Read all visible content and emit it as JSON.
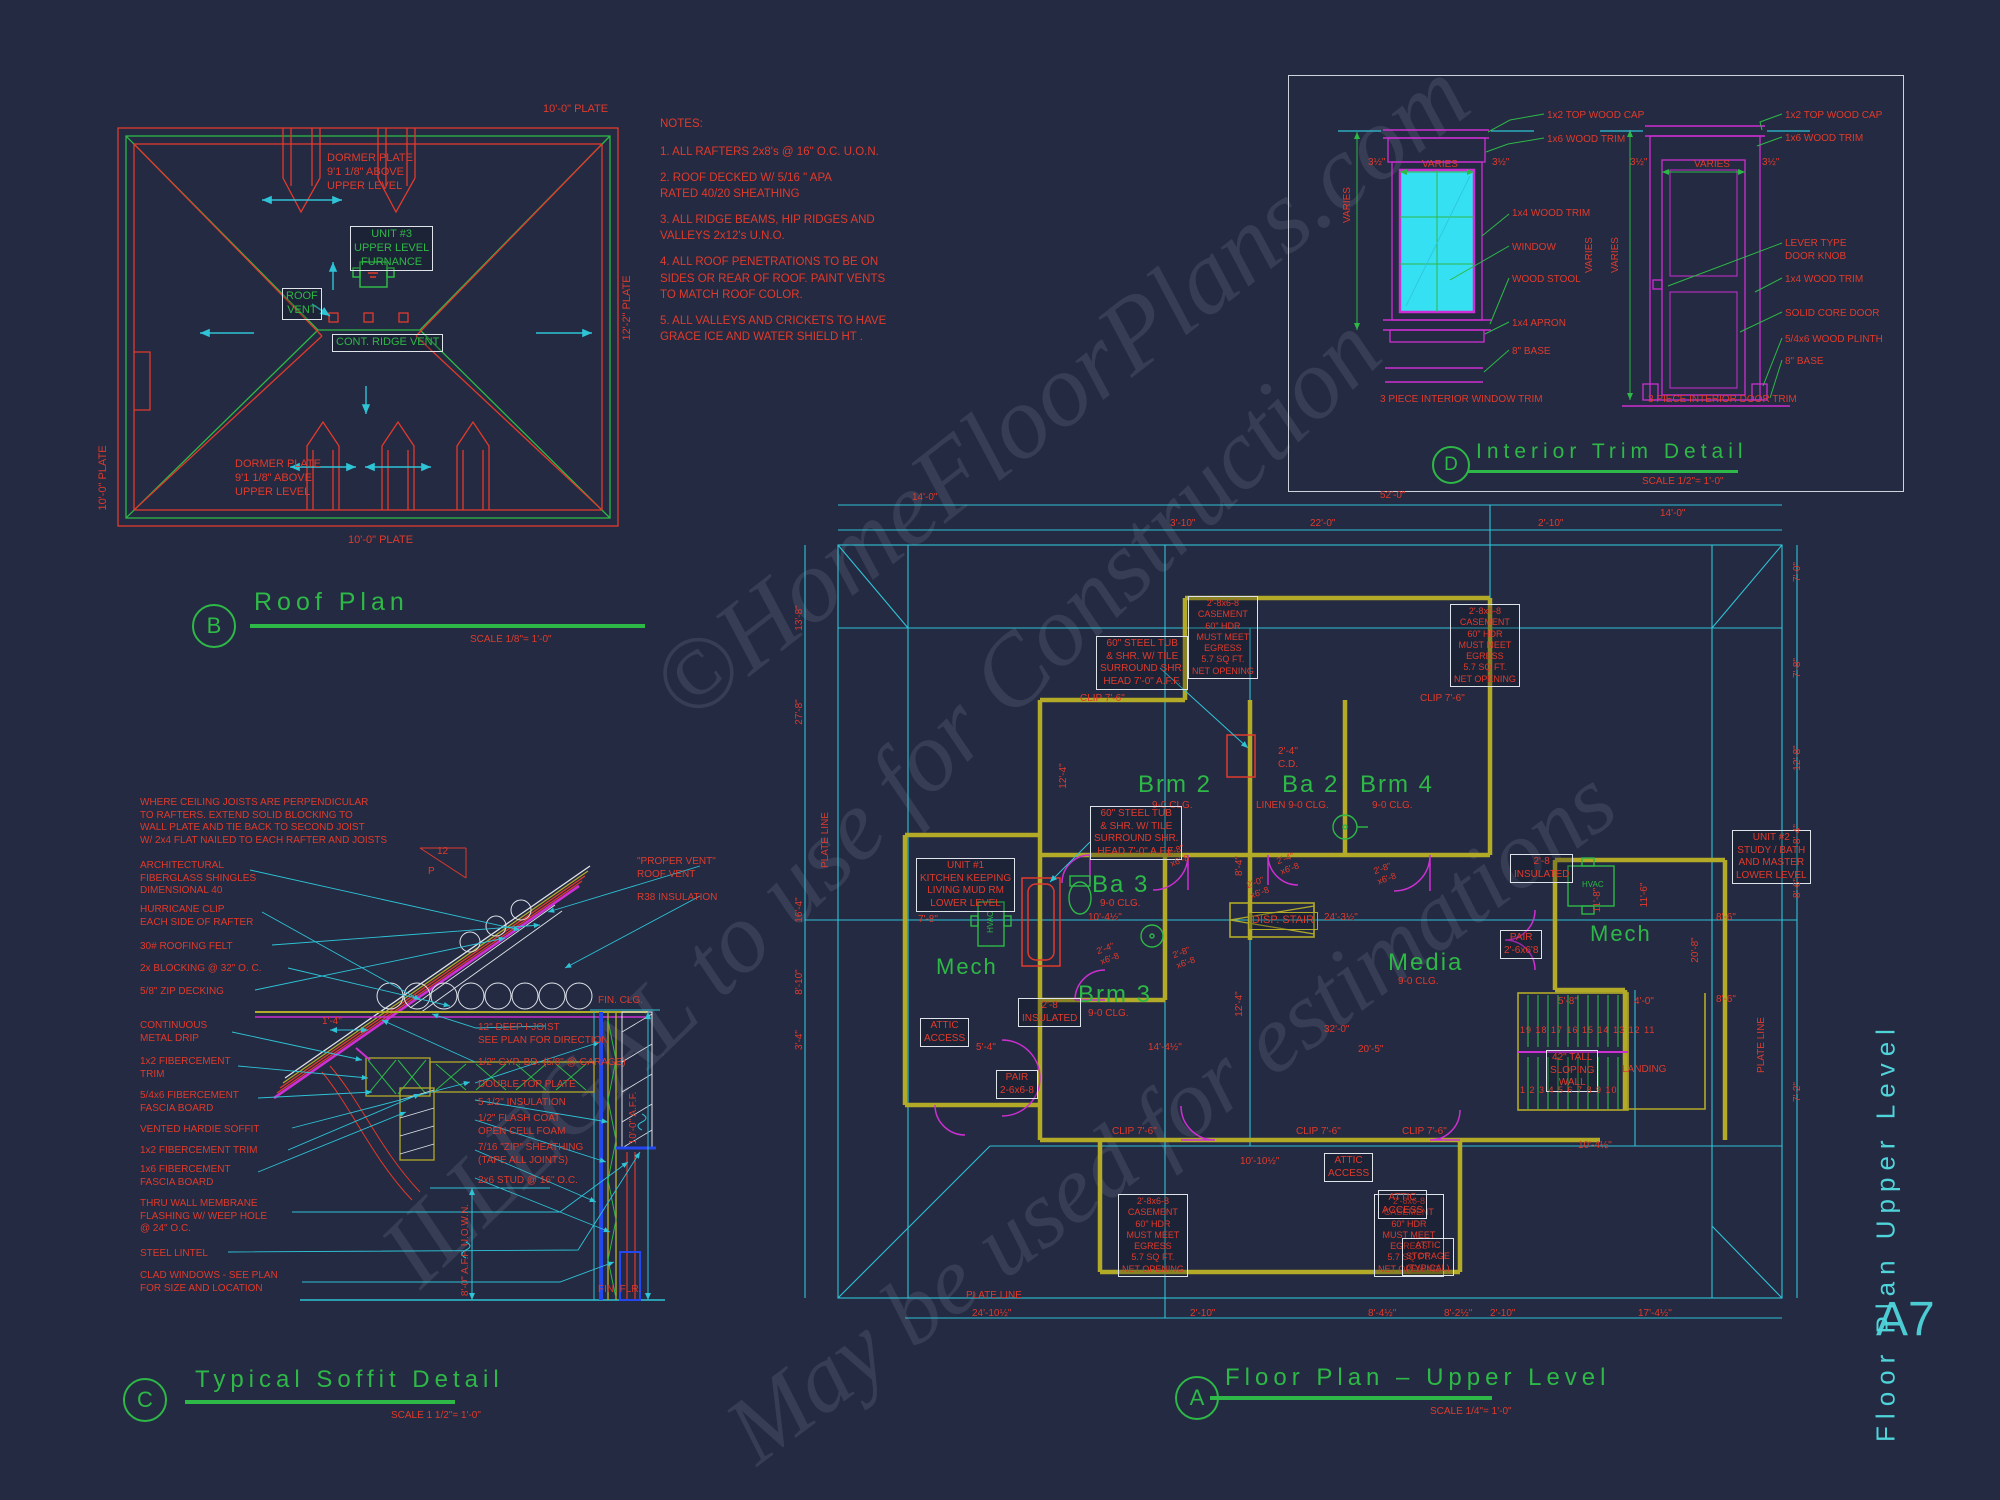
{
  "palette": {
    "red": "#e13a2c",
    "green": "#2eb847",
    "cyan": "#2fc3d6",
    "magenta": "#cd2fd2",
    "yellow": "#b3aa28",
    "white": "#dfe3ea",
    "blue": "#2547f0"
  },
  "sheet": {
    "number": "A7",
    "side_title": "Floor  Plan  Upper  Level"
  },
  "watermark": {
    "line1": "©HomeFloorPlans.com",
    "line2": "ILLEGAL to use for Construction",
    "line3": "May be used for estimations"
  },
  "titles": [
    {
      "letter": "B",
      "title": "Roof Plan",
      "scale": "SCALE 1/8\"= 1'-0\""
    },
    {
      "letter": "C",
      "title": "Typical Soffit Detail",
      "scale": "SCALE 1 1/2\"= 1'-0\""
    },
    {
      "letter": "A",
      "title": "Floor Plan – Upper Level",
      "scale": "SCALE 1/4\"= 1'-0\""
    },
    {
      "letter": "D",
      "title": "Interior Trim Detail",
      "scale": "SCALE 1/2\"= 1'-0\""
    }
  ],
  "notes": {
    "heading": "NOTES:",
    "items": [
      "1. ALL RAFTERS 2x8's @ 16\" O.C. U.O.N.",
      "2. ROOF DECKED W/ 5/16 \" APA\n    RATED 40/20 SHEATHING",
      "3. ALL RIDGE BEAMS, HIP RIDGES AND\n    VALLEYS 2x12's U.N.O.",
      "4. ALL ROOF PENETRATIONS TO BE ON\n    SIDES OR REAR OF ROOF.  PAINT VENTS\n    TO MATCH ROOF COLOR.",
      "5. ALL VALLEYS AND CRICKETS TO HAVE\nGRACE ICE AND WATER SHIELD HT ."
    ]
  },
  "labels": [
    {
      "t": "10'-0\" PLATE",
      "x": 543,
      "y": 103
    },
    {
      "t": "DORMER PLATE\n9'1 1/8\" ABOVE\nUPPER LEVEL",
      "x": 327,
      "y": 152
    },
    {
      "t": "UNIT #3\nUPPER LEVEL\nFURNANCE",
      "x": 350,
      "y": 226,
      "c": "green",
      "b": 1
    },
    {
      "t": "ROOF\nVENT",
      "x": 282,
      "y": 288,
      "c": "green",
      "b": 1
    },
    {
      "t": "CONT. RIDGE VENT",
      "x": 332,
      "y": 334,
      "c": "green",
      "b": 1
    },
    {
      "t": "DORMER PLATE\n9'1 1/8\" ABOVE\nUPPER LEVEL",
      "x": 235,
      "y": 458
    },
    {
      "t": "10'-0\" PLATE",
      "x": 348,
      "y": 534
    },
    {
      "t": "10'-0\" PLATE",
      "x": 104,
      "y": 478,
      "r": -90
    },
    {
      "t": "12'-2\" PLATE",
      "x": 628,
      "y": 308,
      "r": -90
    },
    {
      "t": "1x2 TOP WOOD CAP",
      "x": 1547,
      "y": 110,
      "s": 10
    },
    {
      "t": "1x6 WOOD TRIM",
      "x": 1547,
      "y": 134,
      "s": 10
    },
    {
      "t": "3½\"",
      "x": 1368,
      "y": 157,
      "s": 10
    },
    {
      "t": "VARIES",
      "x": 1422,
      "y": 159,
      "s": 10
    },
    {
      "t": "3½\"",
      "x": 1492,
      "y": 157,
      "s": 10
    },
    {
      "t": "VARIES",
      "x": 1348,
      "y": 205,
      "s": 10,
      "r": -90
    },
    {
      "t": "VARIES",
      "x": 1590,
      "y": 255,
      "s": 10,
      "r": -90
    },
    {
      "t": "1x4 WOOD TRIM",
      "x": 1512,
      "y": 208,
      "s": 10
    },
    {
      "t": "WINDOW",
      "x": 1512,
      "y": 242,
      "s": 10
    },
    {
      "t": "WOOD STOOL",
      "x": 1512,
      "y": 274,
      "s": 10
    },
    {
      "t": "1x4 APRON",
      "x": 1512,
      "y": 318,
      "s": 10
    },
    {
      "t": "8\" BASE",
      "x": 1512,
      "y": 346,
      "s": 10
    },
    {
      "t": "3 PIECE INTERIOR WINDOW TRIM",
      "x": 1380,
      "y": 394,
      "s": 10
    },
    {
      "t": "1x2 TOP WOOD CAP",
      "x": 1785,
      "y": 110,
      "s": 10
    },
    {
      "t": "1x6 WOOD TRIM",
      "x": 1785,
      "y": 133,
      "s": 10
    },
    {
      "t": "3½\"",
      "x": 1630,
      "y": 157,
      "s": 10
    },
    {
      "t": "VARIES",
      "x": 1694,
      "y": 159,
      "s": 10
    },
    {
      "t": "3½\"",
      "x": 1762,
      "y": 157,
      "s": 10
    },
    {
      "t": "VARIES",
      "x": 1616,
      "y": 255,
      "s": 10,
      "r": -90
    },
    {
      "t": "LEVER TYPE\nDOOR KNOB",
      "x": 1785,
      "y": 238,
      "s": 10
    },
    {
      "t": "1x4 WOOD TRIM",
      "x": 1785,
      "y": 274,
      "s": 10
    },
    {
      "t": "SOLID CORE DOOR",
      "x": 1785,
      "y": 308,
      "s": 10
    },
    {
      "t": "5/4x6 WOOD PLINTH",
      "x": 1785,
      "y": 334,
      "s": 10
    },
    {
      "t": "8\" BASE",
      "x": 1785,
      "y": 356,
      "s": 10
    },
    {
      "t": "3 PIECE INTERIOR DOOR TRIM",
      "x": 1648,
      "y": 394,
      "s": 10
    },
    {
      "t": "WHERE CEILING JOISTS ARE PERPENDICULAR\nTO RAFTERS.  EXTEND SOLID BLOCKING TO\nWALL PLATE AND TIE BACK TO SECOND JOIST\nW/ 2x4 FLAT NAILED TO EACH RAFTER AND JOISTS",
      "x": 140,
      "y": 797,
      "s": 10
    },
    {
      "t": "ARCHITECTURAL\nFIBERGLASS SHINGLES\nDIMENSIONAL 40",
      "x": 140,
      "y": 860,
      "s": 10
    },
    {
      "t": "HURRICANE CLIP\nEACH SIDE OF RAFTER",
      "x": 140,
      "y": 904,
      "s": 10
    },
    {
      "t": "30# ROOFING FELT",
      "x": 140,
      "y": 941,
      "s": 10
    },
    {
      "t": "2x BLOCKING @ 32\" O. C.",
      "x": 140,
      "y": 963,
      "s": 10
    },
    {
      "t": "5/8\" ZIP DECKING",
      "x": 140,
      "y": 986,
      "s": 10
    },
    {
      "t": "CONTINUOUS\nMETAL DRIP",
      "x": 140,
      "y": 1020,
      "s": 10
    },
    {
      "t": "1x2 FIBERCEMENT\nTRIM",
      "x": 140,
      "y": 1056,
      "s": 10
    },
    {
      "t": "5/4x6 FIBERCEMENT\nFASCIA BOARD",
      "x": 140,
      "y": 1090,
      "s": 10
    },
    {
      "t": "VENTED HARDIE SOFFIT",
      "x": 140,
      "y": 1124,
      "s": 10
    },
    {
      "t": "1x2 FIBERCEMENT TRIM",
      "x": 140,
      "y": 1145,
      "s": 10
    },
    {
      "t": "1x6 FIBERCEMENT\nFASCIA BOARD",
      "x": 140,
      "y": 1164,
      "s": 10
    },
    {
      "t": "THRU WALL MEMBRANE\nFLASHING W/ WEEP HOLE\n@ 24\" O.C.",
      "x": 140,
      "y": 1198,
      "s": 10
    },
    {
      "t": "STEEL LINTEL",
      "x": 140,
      "y": 1248,
      "s": 10
    },
    {
      "t": "CLAD WINDOWS - SEE PLAN\nFOR SIZE AND LOCATION",
      "x": 140,
      "y": 1270,
      "s": 10
    },
    {
      "t": "\"PROPER VENT\"\nROOF VENT",
      "x": 637,
      "y": 856,
      "s": 10
    },
    {
      "t": "R38 INSULATION",
      "x": 637,
      "y": 892,
      "s": 10
    },
    {
      "t": "FIN. CLG.",
      "x": 598,
      "y": 995,
      "s": 10
    },
    {
      "t": "12\" DEEP I-JOIST\nSEE PLAN FOR DIRECTION",
      "x": 478,
      "y": 1022,
      "s": 10
    },
    {
      "t": "1/2\" GYP. BD. (5/8\" @ GARAGE)",
      "x": 478,
      "y": 1057,
      "s": 10
    },
    {
      "t": "DOUBLE TOP PLATE",
      "x": 478,
      "y": 1079,
      "s": 10
    },
    {
      "t": "5 1/2\" INSULATION",
      "x": 478,
      "y": 1097,
      "s": 10
    },
    {
      "t": "1/2\"  FLASH COAT\nOPEN CELL FOAM",
      "x": 478,
      "y": 1113,
      "s": 10
    },
    {
      "t": "7/16 \"ZIP\" SHEATHING\n(TAPE ALL JOINTS)",
      "x": 478,
      "y": 1142,
      "s": 10
    },
    {
      "t": "2x6 STUD @ 16\" O.C.",
      "x": 478,
      "y": 1175,
      "s": 10
    },
    {
      "t": "8'-0\" A.F.F. U.O.W.N.",
      "x": 466,
      "y": 1250,
      "r": -90,
      "s": 10
    },
    {
      "t": "10'-0\" A.F.F.",
      "x": 634,
      "y": 1118,
      "r": -90,
      "s": 10
    },
    {
      "t": "FIN. FLR.",
      "x": 598,
      "y": 1284,
      "s": 10
    },
    {
      "t": "1'-4\"",
      "x": 322,
      "y": 1016,
      "s": 10
    },
    {
      "t": "12",
      "x": 437,
      "y": 846,
      "s": 10
    },
    {
      "t": "P",
      "x": 428,
      "y": 866,
      "s": 10
    },
    {
      "t": "Brm  2",
      "x": 1138,
      "y": 770,
      "c": "green",
      "s": 24,
      "ls": 2
    },
    {
      "t": "Ba  2",
      "x": 1282,
      "y": 770,
      "c": "green",
      "s": 24,
      "ls": 2
    },
    {
      "t": "Brm  4",
      "x": 1360,
      "y": 770,
      "c": "green",
      "s": 24,
      "ls": 2
    },
    {
      "t": "Ba  3",
      "x": 1092,
      "y": 870,
      "c": "green",
      "s": 24,
      "ls": 2
    },
    {
      "t": "Brm  3",
      "x": 1078,
      "y": 980,
      "c": "green",
      "s": 24,
      "ls": 2
    },
    {
      "t": "Media",
      "x": 1388,
      "y": 948,
      "c": "green",
      "s": 24,
      "ls": 2
    },
    {
      "t": "Mech",
      "x": 936,
      "y": 953,
      "c": "green",
      "s": 22,
      "ls": 2
    },
    {
      "t": "Mech",
      "x": 1590,
      "y": 920,
      "c": "green",
      "s": 22,
      "ls": 2
    },
    {
      "t": "9-0 CLG.",
      "x": 1152,
      "y": 800,
      "s": 10
    },
    {
      "t": "LINEN  9-0 CLG.",
      "x": 1256,
      "y": 800,
      "s": 10
    },
    {
      "t": "9-0 CLG.",
      "x": 1372,
      "y": 800,
      "s": 10
    },
    {
      "t": "9-0 CLG.",
      "x": 1100,
      "y": 898,
      "s": 10
    },
    {
      "t": "9-0 CLG.",
      "x": 1088,
      "y": 1008,
      "s": 10
    },
    {
      "t": "9-0 CLG.",
      "x": 1398,
      "y": 976,
      "s": 10
    },
    {
      "t": "HVAC",
      "x": 991,
      "y": 922,
      "c": "green",
      "s": 8,
      "r": -90
    },
    {
      "t": "HVAC",
      "x": 1582,
      "y": 880,
      "c": "green",
      "s": 8
    },
    {
      "t": "UNIT #1\nKITCHEN KEEPING\nLIVING MUD RM\nLOWER LEVEL",
      "x": 916,
      "y": 858,
      "b": 1,
      "s": 10
    },
    {
      "t": "UNIT #2\nSTUDY / BATH\nAND MASTER\nLOWER LEVEL",
      "x": 1732,
      "y": 830,
      "b": 1,
      "s": 10
    },
    {
      "t": "60\" STEEL TUB\n& SHR. W/ TILE\nSURROUND SHR.\nHEAD 7'-0\"  A.F.F.",
      "x": 1090,
      "y": 806,
      "b": 1,
      "s": 10
    },
    {
      "t": "60\" STEEL TUB\n& SHR. W/ TILE\nSURROUND SHR.\nHEAD 7'-0\" A.F.F.",
      "x": 1096,
      "y": 636,
      "b": 1,
      "s": 10
    },
    {
      "t": "2'-8x6-8\nCASEMENT\n60\" HDR\nMUST MEET\nEGRESS\n5.7 SQ FT.\nNET OPENING",
      "x": 1188,
      "y": 596,
      "b": 1,
      "s": 9
    },
    {
      "t": "2'-8x6-8\nCASEMENT\n60\" HDR\nMUST MEET\nEGRESS\n5.7 SQ FT.\nNET OPENING",
      "x": 1450,
      "y": 604,
      "b": 1,
      "s": 9
    },
    {
      "t": "2'-8x6-8\nCASEMENT\n60\" HDR\nMUST MEET\nEGRESS\n5.7 SQ FT.\nNET OPENING",
      "x": 1118,
      "y": 1194,
      "b": 1,
      "s": 9
    },
    {
      "t": "2'-8x6-8\nCASEMENT\n60\" HDR\nMUST MEET\nEGRESS\n5.7 SQ FT.\nNET OPENING",
      "x": 1374,
      "y": 1194,
      "b": 1,
      "s": 9
    },
    {
      "t": "ATTIC\nACCESS",
      "x": 920,
      "y": 1018,
      "b": 1,
      "s": 10
    },
    {
      "t": "ATTIC\nACCESS",
      "x": 1324,
      "y": 1153,
      "b": 1,
      "s": 10
    },
    {
      "t": "ATTIC\nACCESS",
      "x": 1378,
      "y": 1190,
      "b": 1,
      "s": 10
    },
    {
      "t": "2'-8\nINSULATED",
      "x": 1018,
      "y": 998,
      "b": 1,
      "s": 10
    },
    {
      "t": "2'-8\nINSULATED",
      "x": 1510,
      "y": 854,
      "b": 1,
      "s": 10
    },
    {
      "t": "PAIR\n2-6x6-8",
      "x": 996,
      "y": 1070,
      "b": 1,
      "s": 10
    },
    {
      "t": "PAIR\n2'-6x6'8",
      "x": 1500,
      "y": 930,
      "b": 1,
      "s": 10
    },
    {
      "t": "42\" TALL\nSLOPING\nWALL",
      "x": 1546,
      "y": 1050,
      "b": 1,
      "s": 10
    },
    {
      "t": "ATTIC\nSTORAGE\n(TYPICAL)",
      "x": 1402,
      "y": 1238,
      "b": 1,
      "s": 9
    },
    {
      "t": "DISP. STAIR",
      "x": 1248,
      "y": 912,
      "b": 2,
      "s": 11
    },
    {
      "t": "LANDING",
      "x": 1622,
      "y": 1064,
      "s": 10
    },
    {
      "t": "PLATE LINE",
      "x": 1762,
      "y": 1045,
      "r": -90,
      "s": 10
    },
    {
      "t": "PLATE LINE",
      "x": 826,
      "y": 840,
      "r": -90,
      "s": 10
    },
    {
      "t": "PLATE LINE",
      "x": 966,
      "y": 1290,
      "s": 10
    },
    {
      "t": "CLIP 7'-6\"",
      "x": 1080,
      "y": 693,
      "s": 10
    },
    {
      "t": "CLIP 7'-6\"",
      "x": 1420,
      "y": 693,
      "s": 10
    },
    {
      "t": "CLIP 7'-6\"",
      "x": 1112,
      "y": 1126,
      "s": 10
    },
    {
      "t": "CLIP 7'-6\"",
      "x": 1296,
      "y": 1126,
      "s": 10
    },
    {
      "t": "CLIP 7'-6\"",
      "x": 1402,
      "y": 1126,
      "s": 10
    },
    {
      "t": "2'-4\"\nC.D.",
      "x": 1278,
      "y": 746,
      "s": 10
    },
    {
      "t": "19 18 17 16 15 14 13 12 11",
      "x": 1520,
      "y": 1025,
      "s": 9,
      "ls": 1
    },
    {
      "t": "1  2  3  4  5  6  7  8  9  10",
      "x": 1520,
      "y": 1085,
      "s": 9,
      "ls": 1
    },
    {
      "t": "2'-8\"\nx6'-8",
      "x": 1178,
      "y": 856,
      "s": 9,
      "r": -20
    },
    {
      "t": "2'-4\"\nx6'-8",
      "x": 1288,
      "y": 864,
      "s": 9,
      "r": -20
    },
    {
      "t": "2'-0\"\nx6'-8",
      "x": 1258,
      "y": 888,
      "s": 9,
      "r": -20
    },
    {
      "t": "2'-8\"\nx6'-8",
      "x": 1385,
      "y": 874,
      "s": 9,
      "r": -20
    },
    {
      "t": "2'-4\"\nx6'-8",
      "x": 1108,
      "y": 954,
      "s": 9,
      "r": -20
    },
    {
      "t": "2'-8\"\nx6'-8",
      "x": 1184,
      "y": 958,
      "s": 9,
      "r": -20
    },
    {
      "t": "14'-0\"",
      "x": 912,
      "y": 492,
      "s": 10
    },
    {
      "t": "52'-0\"",
      "x": 1380,
      "y": 490,
      "s": 10
    },
    {
      "t": "14'-0\"",
      "x": 1660,
      "y": 508,
      "s": 10
    },
    {
      "t": "3'-10\"",
      "x": 1170,
      "y": 518,
      "s": 10
    },
    {
      "t": "22'-0\"",
      "x": 1310,
      "y": 518,
      "s": 10
    },
    {
      "t": "2'-10\"",
      "x": 1538,
      "y": 518,
      "s": 10
    },
    {
      "t": "13'-8\"",
      "x": 800,
      "y": 618,
      "r": -90,
      "s": 10
    },
    {
      "t": "27'-8\"",
      "x": 800,
      "y": 712,
      "r": -90,
      "s": 10
    },
    {
      "t": "16'-4\"",
      "x": 800,
      "y": 910,
      "r": -90,
      "s": 10
    },
    {
      "t": "8'-10\"",
      "x": 800,
      "y": 982,
      "r": -90,
      "s": 10
    },
    {
      "t": "3'-4\"",
      "x": 800,
      "y": 1040,
      "r": -90,
      "s": 10
    },
    {
      "t": "7'-0\"",
      "x": 1798,
      "y": 572,
      "r": -90,
      "s": 10
    },
    {
      "t": "7'-8\"",
      "x": 1798,
      "y": 668,
      "r": -90,
      "s": 10
    },
    {
      "t": "12'-8\"",
      "x": 1798,
      "y": 758,
      "r": -90,
      "s": 10
    },
    {
      "t": "8'-4\"",
      "x": 1798,
      "y": 834,
      "r": -90,
      "s": 10
    },
    {
      "t": "8'-6\"",
      "x": 1798,
      "y": 888,
      "r": -90,
      "s": 10
    },
    {
      "t": "7'-2\"",
      "x": 1798,
      "y": 1092,
      "r": -90,
      "s": 10
    },
    {
      "t": "11'-6\"",
      "x": 1645,
      "y": 895,
      "r": -90,
      "s": 10
    },
    {
      "t": "20'-8\"",
      "x": 1696,
      "y": 950,
      "r": -90,
      "s": 10
    },
    {
      "t": "8'-6\"",
      "x": 1716,
      "y": 912,
      "s": 10
    },
    {
      "t": "8'-6\"",
      "x": 1716,
      "y": 994,
      "s": 10
    },
    {
      "t": "24'-10½\"",
      "x": 972,
      "y": 1308,
      "s": 10
    },
    {
      "t": "2'-10\"",
      "x": 1190,
      "y": 1308,
      "s": 10
    },
    {
      "t": "8'-4½\"",
      "x": 1368,
      "y": 1308,
      "s": 10
    },
    {
      "t": "8'-2½\"",
      "x": 1444,
      "y": 1308,
      "s": 10
    },
    {
      "t": "2'-10\"",
      "x": 1490,
      "y": 1308,
      "s": 10
    },
    {
      "t": "17'-4½\"",
      "x": 1638,
      "y": 1308,
      "s": 10
    },
    {
      "t": "10'-10½\"",
      "x": 1240,
      "y": 1156,
      "s": 10
    },
    {
      "t": "10'-4½\"",
      "x": 1088,
      "y": 912,
      "s": 10
    },
    {
      "t": "24'-3½\"",
      "x": 1324,
      "y": 912,
      "s": 10
    },
    {
      "t": "14'-4½\"",
      "x": 1148,
      "y": 1042,
      "s": 10
    },
    {
      "t": "20'-5\"",
      "x": 1358,
      "y": 1044,
      "s": 10
    },
    {
      "t": "32'-0\"",
      "x": 1324,
      "y": 1024,
      "s": 10
    },
    {
      "t": "10'-4½\"",
      "x": 1578,
      "y": 1140,
      "s": 10
    },
    {
      "t": "7'-8\"",
      "x": 918,
      "y": 914,
      "s": 10
    },
    {
      "t": "5'-4\"",
      "x": 976,
      "y": 1042,
      "s": 10
    },
    {
      "t": "4'-0\"",
      "x": 1634,
      "y": 996,
      "s": 10
    },
    {
      "t": "5'-8\"",
      "x": 1558,
      "y": 996,
      "s": 10
    },
    {
      "t": "12'-4\"",
      "x": 1064,
      "y": 776,
      "r": -90,
      "s": 10
    },
    {
      "t": "12'-4\"",
      "x": 1240,
      "y": 1004,
      "r": -90,
      "s": 10
    },
    {
      "t": "8'-4\"",
      "x": 1240,
      "y": 866,
      "r": -90,
      "s": 10
    },
    {
      "t": "11'-8\"",
      "x": 1598,
      "y": 900,
      "r": -90,
      "s": 10
    }
  ]
}
